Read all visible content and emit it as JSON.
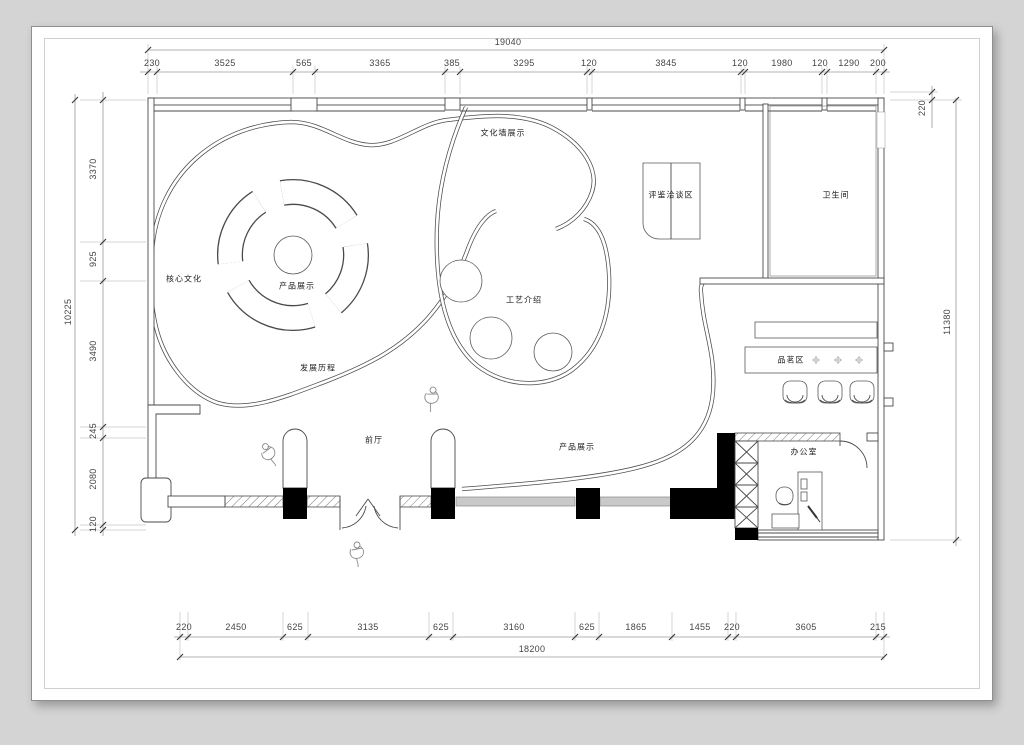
{
  "sheet": {
    "background": "#d4d4d4",
    "paper": "#ffffff",
    "line_color": "#4a4a4a",
    "dim_text_color": "#444444",
    "glazing_color": "#c9c9c9",
    "column_fill": "#000000"
  },
  "dimensions": {
    "top": {
      "total": "19040",
      "segments": [
        "230",
        "3525",
        "565",
        "3365",
        "385",
        "3295",
        "120",
        "3845",
        "120",
        "1980",
        "120",
        "1290",
        "200"
      ]
    },
    "bottom": {
      "total": "18200",
      "segments": [
        "220",
        "2450",
        "625",
        "3135",
        "625",
        "3160",
        "625",
        "1865",
        "1455",
        "220",
        "3605",
        "215"
      ]
    },
    "left": {
      "total": "10225",
      "segments": [
        "3370",
        "925",
        "3490",
        "245",
        "2080",
        "120"
      ]
    },
    "right": {
      "total": "11380",
      "segments": [
        "220"
      ]
    }
  },
  "rooms": {
    "culture_wall": "文化墙展示",
    "tasting": "评鉴洽谈区",
    "bathroom": "卫生间",
    "core_culture": "核心文化",
    "product_display_main": "产品展示",
    "craft_intro": "工艺介绍",
    "development": "发展历程",
    "tea_area": "品茗区",
    "front_hall": "前厅",
    "product_display_front": "产品展示",
    "office": "办公室"
  }
}
